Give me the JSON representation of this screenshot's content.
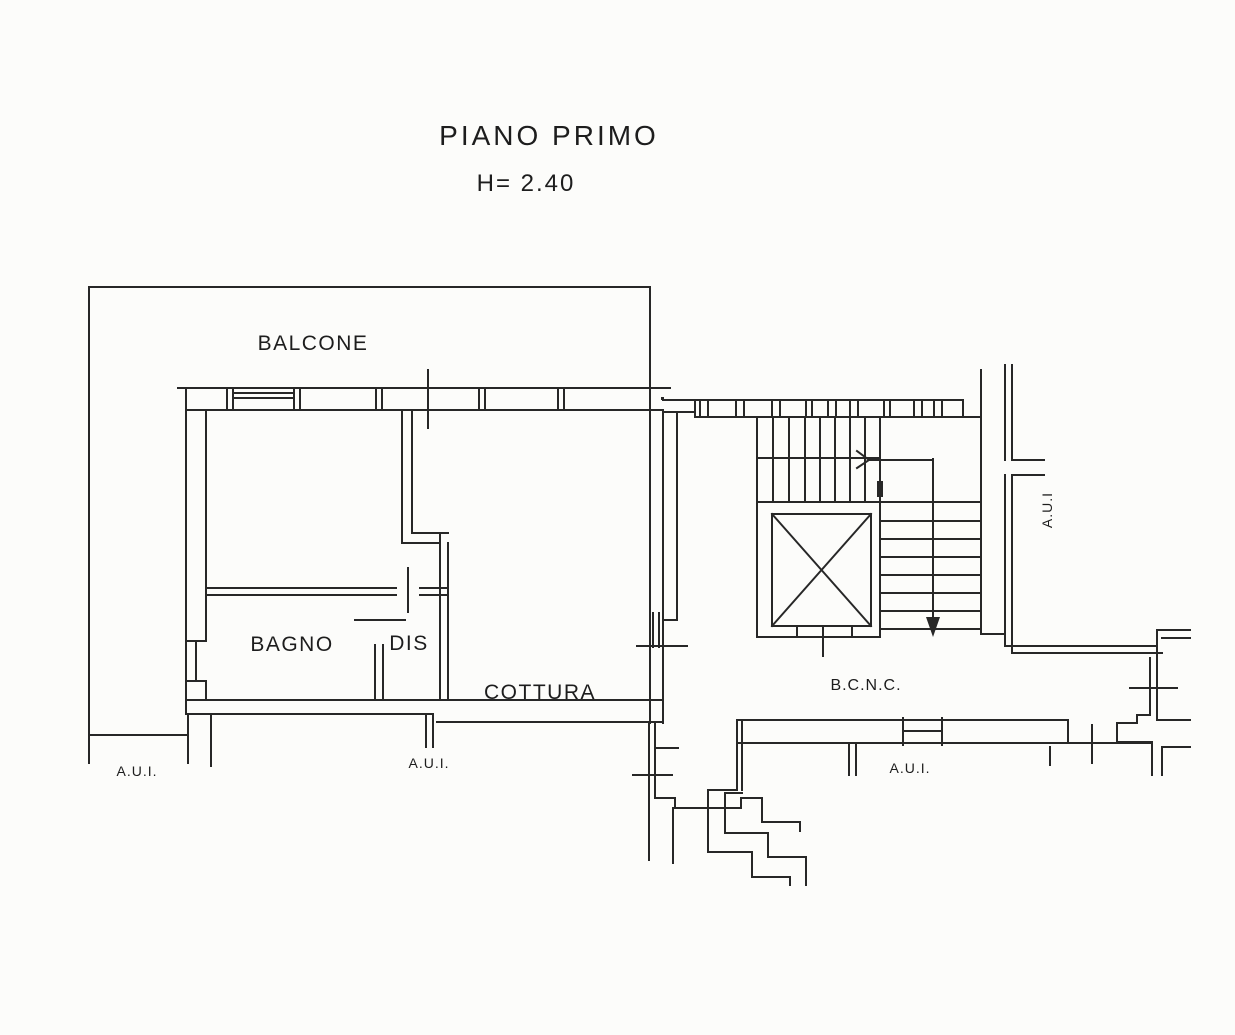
{
  "page": {
    "background": "#fcfcfa",
    "ink": "#222222",
    "type": "scanned floor plan"
  },
  "title": {
    "text": "PIANO PRIMO",
    "height_note": "H= 2.40"
  },
  "plan": {
    "rooms": [
      {
        "id": "balcone",
        "label": "BALCONE"
      },
      {
        "id": "bagno",
        "label": "BAGNO"
      },
      {
        "id": "dis",
        "label": "DIS"
      },
      {
        "id": "cottura",
        "label": "COTTURA"
      },
      {
        "id": "bcnc",
        "label": "B.C.N.C."
      }
    ],
    "annotations": [
      {
        "id": "aui-left",
        "label": "A.U.I."
      },
      {
        "id": "aui-middle",
        "label": "A.U.I."
      },
      {
        "id": "aui-bottom-right",
        "label": "A.U.I."
      },
      {
        "id": "aui-right-vertical",
        "label": "A.U.I"
      }
    ],
    "symbols": [
      {
        "id": "stair-down-arrow",
        "meaning": "stair direction arrow"
      },
      {
        "id": "elevator-cross",
        "meaning": "elevator shaft X"
      }
    ]
  }
}
